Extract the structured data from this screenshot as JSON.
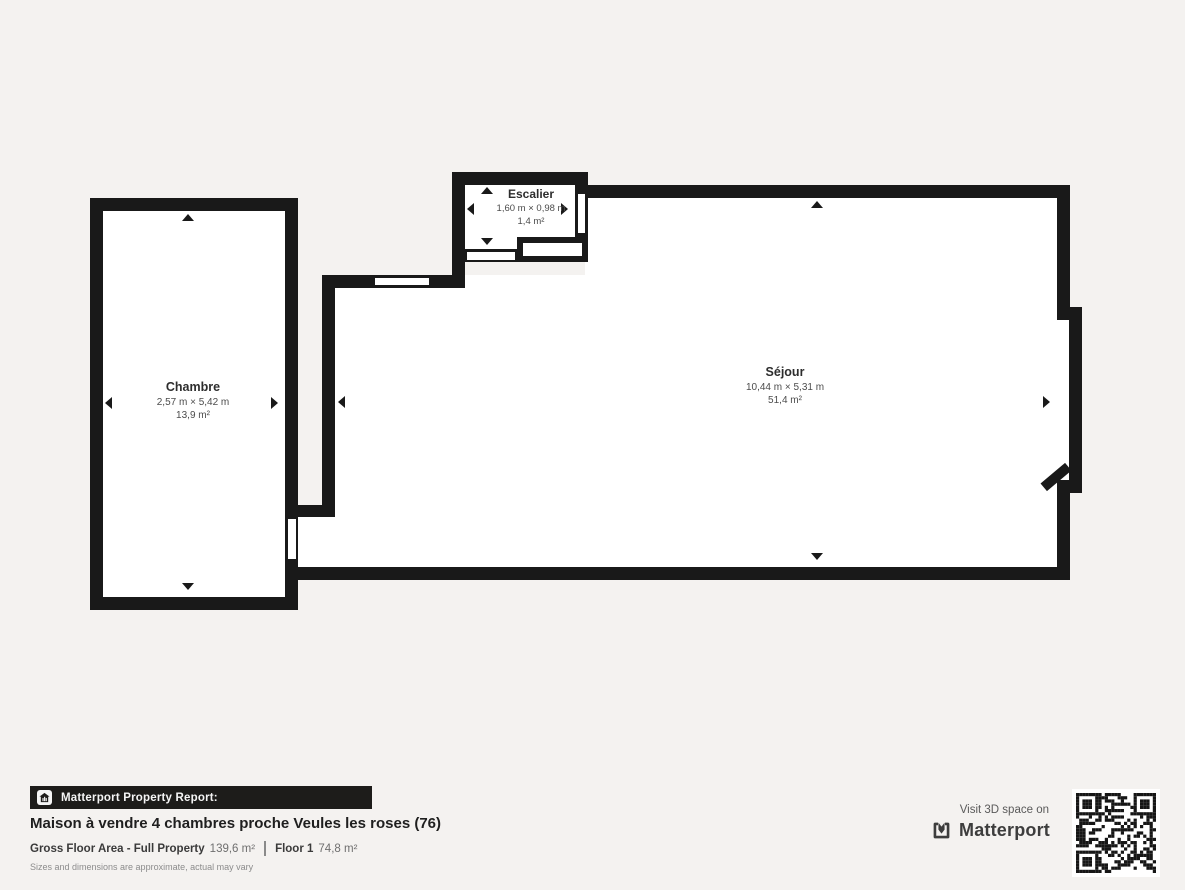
{
  "plan": {
    "rooms": [
      {
        "name": "Chambre",
        "dimensions": "2,57 m × 5,42 m",
        "area": "13,9 m²"
      },
      {
        "name": "Séjour",
        "dimensions": "10,44 m × 5,31 m",
        "area": "51,4 m²"
      },
      {
        "name": "Escalier",
        "dimensions": "1,60 m × 0,98 m",
        "area": "1,4 m²"
      }
    ]
  },
  "footer": {
    "report_label": "Matterport Property Report:",
    "title": "Maison à vendre 4 chambres proche Veules les roses (76)",
    "gross_label": "Gross Floor Area - Full Property",
    "gross_value": "139,6 m²",
    "floor_label": "Floor 1",
    "floor_value": "74,8 m²",
    "disclaimer": "Sizes and dimensions are approximate, actual may vary",
    "visit_text": "Visit 3D space on",
    "brand": "Matterport"
  },
  "colors": {
    "background": "#f4f2f0",
    "wall": "#191919",
    "room_fill": "#ffffff",
    "bar_background": "#1d1c1a",
    "bar_text": "#f5f5f5"
  }
}
